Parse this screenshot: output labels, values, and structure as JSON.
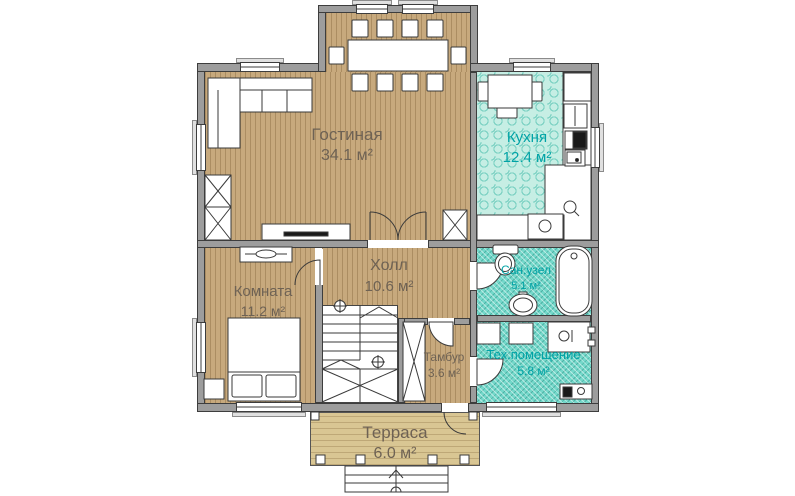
{
  "plan": {
    "type": "floor-plan",
    "rooms": [
      {
        "name": "Гостиная",
        "area": "34.1 м²"
      },
      {
        "name": "Кухня",
        "area": "12.4 м²"
      },
      {
        "name": "Холл",
        "area": "10.6 м²"
      },
      {
        "name": "Комната",
        "area": "11.2 м²"
      },
      {
        "name": "Сан.узел",
        "area": "5.1 м²"
      },
      {
        "name": "Тамбур",
        "area": "3.6 м²"
      },
      {
        "name": "Тех.помещение",
        "area": "5.8 м²"
      },
      {
        "name": "Терраса",
        "area": "6.0 м²"
      }
    ],
    "colors": {
      "wall": "#9d9d9d",
      "wood_floor": "#c7a97d",
      "terrace_floor": "#d9c693",
      "kitchen_tile": "#c6eee4",
      "wet_tile": "#74d8ca",
      "label_warm": "#6e6254",
      "label_teal": "#00a3a6",
      "outline": "#3d3d3d"
    }
  }
}
